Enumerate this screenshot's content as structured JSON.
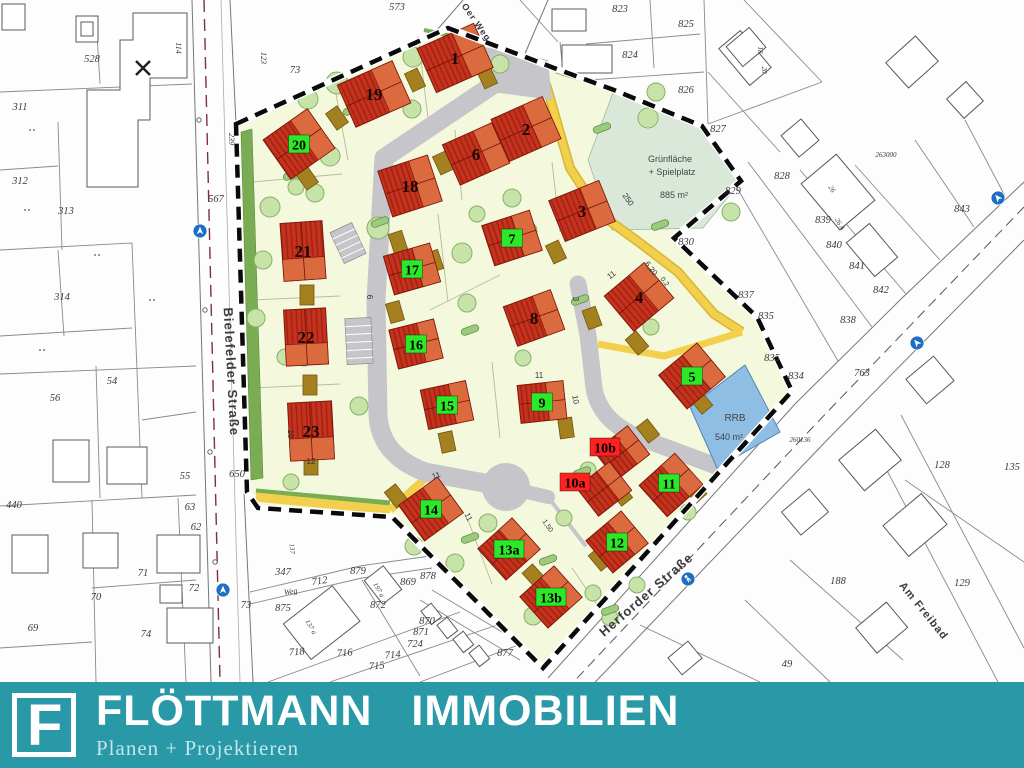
{
  "logo": {
    "brand": "FLÖTTMANN IMMOBILIEN",
    "tagline": "Planen + Projektieren",
    "mark_letter": "F",
    "bar_color": "#2998A7"
  },
  "map": {
    "street_labels": [
      {
        "text": "Bielefelder Straße",
        "x": 227,
        "y": 372,
        "rot": 87,
        "size": 13
      },
      {
        "text": "Herforder Straße",
        "x": 649,
        "y": 598,
        "rot": -41,
        "size": 13
      },
      {
        "text": "Am Freibad",
        "x": 921,
        "y": 613,
        "rot": 51,
        "size": 11
      },
      {
        "text": "Oer Weg",
        "x": 474,
        "y": 24,
        "rot": 55,
        "size": 9
      }
    ],
    "area_labels": [
      {
        "text": "Grünfläche",
        "x": 670,
        "y": 162,
        "size": 9
      },
      {
        "text": "+ Spielplatz",
        "x": 672,
        "y": 175,
        "size": 9
      },
      {
        "text": "885 m²",
        "x": 674,
        "y": 198,
        "size": 9
      },
      {
        "text": "RRB",
        "x": 735,
        "y": 421,
        "size": 10
      },
      {
        "text": "540 m²",
        "x": 729,
        "y": 440,
        "size": 9
      }
    ],
    "lots": [
      {
        "id": "1",
        "badge": "none",
        "x": 455,
        "y": 58,
        "hw": 62,
        "hh": 48,
        "rot": -24
      },
      {
        "id": "19",
        "badge": "none",
        "x": 374,
        "y": 94,
        "hw": 60,
        "hh": 46,
        "rot": -24
      },
      {
        "id": "20",
        "badge": "green",
        "x": 299,
        "y": 144,
        "hw": 54,
        "hh": 48,
        "rot": -35
      },
      {
        "id": "2",
        "badge": "none",
        "x": 526,
        "y": 129,
        "hw": 56,
        "hh": 46,
        "rot": -24
      },
      {
        "id": "6",
        "badge": "none",
        "x": 476,
        "y": 154,
        "hw": 54,
        "hh": 44,
        "rot": -24
      },
      {
        "id": "18",
        "badge": "none",
        "x": 410,
        "y": 186,
        "hw": 52,
        "hh": 48,
        "rot": -18
      },
      {
        "id": "3",
        "badge": "none",
        "x": 582,
        "y": 211,
        "hw": 54,
        "hh": 44,
        "rot": -22
      },
      {
        "id": "7",
        "badge": "green",
        "x": 512,
        "y": 238,
        "hw": 50,
        "hh": 42,
        "rot": -18
      },
      {
        "id": "21",
        "badge": "none",
        "x": 303,
        "y": 251,
        "hw": 42,
        "hh": 58,
        "rot": -4
      },
      {
        "id": "17",
        "badge": "green",
        "x": 412,
        "y": 269,
        "hw": 48,
        "hh": 40,
        "rot": -16
      },
      {
        "id": "4",
        "badge": "none",
        "x": 639,
        "y": 297,
        "hw": 52,
        "hh": 46,
        "rot": -40
      },
      {
        "id": "8",
        "badge": "none",
        "x": 534,
        "y": 318,
        "hw": 50,
        "hh": 42,
        "rot": -20
      },
      {
        "id": "22",
        "badge": "none",
        "x": 306,
        "y": 337,
        "hw": 42,
        "hh": 56,
        "rot": -3
      },
      {
        "id": "16",
        "badge": "green",
        "x": 416,
        "y": 344,
        "hw": 46,
        "hh": 40,
        "rot": -14
      },
      {
        "id": "5",
        "badge": "green",
        "x": 692,
        "y": 376,
        "hw": 50,
        "hh": 44,
        "rot": -40
      },
      {
        "id": "15",
        "badge": "green",
        "x": 447,
        "y": 405,
        "hw": 46,
        "hh": 40,
        "rot": -12
      },
      {
        "id": "9",
        "badge": "green",
        "x": 542,
        "y": 402,
        "hw": 46,
        "hh": 38,
        "rot": -6
      },
      {
        "id": "23",
        "badge": "none",
        "x": 311,
        "y": 431,
        "hw": 44,
        "hh": 58,
        "rot": -3
      },
      {
        "id": "10b",
        "badge": "red",
        "x": 622,
        "y": 453,
        "hw": 42,
        "hh": 36,
        "rot": -38,
        "dx": -17,
        "dy": -6
      },
      {
        "id": "10a",
        "badge": "red",
        "x": 604,
        "y": 489,
        "hw": 42,
        "hh": 36,
        "rot": -38,
        "dx": -29,
        "dy": -7
      },
      {
        "id": "11",
        "badge": "green",
        "x": 671,
        "y": 485,
        "hw": 48,
        "hh": 42,
        "rot": -42,
        "dx": -2,
        "dy": -2
      },
      {
        "id": "14",
        "badge": "green",
        "x": 431,
        "y": 509,
        "hw": 48,
        "hh": 44,
        "rot": -36
      },
      {
        "id": "12",
        "badge": "green",
        "x": 617,
        "y": 542,
        "hw": 46,
        "hh": 42,
        "rot": -40
      },
      {
        "id": "13a",
        "badge": "green",
        "x": 509,
        "y": 549,
        "hw": 46,
        "hh": 42,
        "rot": -42
      },
      {
        "id": "13b",
        "badge": "green",
        "x": 551,
        "y": 597,
        "hw": 46,
        "hh": 42,
        "rot": -42
      }
    ],
    "parcel_labels": [
      {
        "t": "528",
        "x": 92,
        "y": 62
      },
      {
        "t": "311",
        "x": 20,
        "y": 110
      },
      {
        "t": "312",
        "x": 20,
        "y": 184
      },
      {
        "t": "313",
        "x": 66,
        "y": 214
      },
      {
        "t": "314",
        "x": 62,
        "y": 300
      },
      {
        "t": "567",
        "x": 216,
        "y": 202
      },
      {
        "t": "239",
        "x": 229,
        "y": 139,
        "r": 90,
        "s": 8
      },
      {
        "t": "114",
        "x": 176,
        "y": 48,
        "r": 90,
        "s": 8
      },
      {
        "t": "123",
        "x": 261,
        "y": 58,
        "r": 90,
        "s": 8
      },
      {
        "t": "73",
        "x": 295,
        "y": 73
      },
      {
        "t": "573",
        "x": 397,
        "y": 10
      },
      {
        "t": "56",
        "x": 55,
        "y": 401
      },
      {
        "t": "54",
        "x": 112,
        "y": 384
      },
      {
        "t": "55",
        "x": 185,
        "y": 479
      },
      {
        "t": "440",
        "x": 14,
        "y": 508
      },
      {
        "t": "63",
        "x": 190,
        "y": 510
      },
      {
        "t": "62",
        "x": 196,
        "y": 530
      },
      {
        "t": "650",
        "x": 237,
        "y": 477
      },
      {
        "t": "70",
        "x": 96,
        "y": 600
      },
      {
        "t": "71",
        "x": 143,
        "y": 576
      },
      {
        "t": "72",
        "x": 194,
        "y": 591
      },
      {
        "t": "73",
        "x": 246,
        "y": 608
      },
      {
        "t": "74",
        "x": 146,
        "y": 637
      },
      {
        "t": "69",
        "x": 33,
        "y": 631
      },
      {
        "t": "347",
        "x": 283,
        "y": 575
      },
      {
        "t": "712",
        "x": 320,
        "y": 584,
        "r": -8
      },
      {
        "t": "Weg",
        "x": 291,
        "y": 594,
        "r": -8,
        "s": 8
      },
      {
        "t": "875",
        "x": 283,
        "y": 611
      },
      {
        "t": "879",
        "x": 358,
        "y": 574
      },
      {
        "t": "872",
        "x": 378,
        "y": 608
      },
      {
        "t": "869",
        "x": 408,
        "y": 585
      },
      {
        "t": "878",
        "x": 428,
        "y": 579
      },
      {
        "t": "870",
        "x": 427,
        "y": 624
      },
      {
        "t": "871",
        "x": 421,
        "y": 635
      },
      {
        "t": "724",
        "x": 415,
        "y": 647
      },
      {
        "t": "718",
        "x": 297,
        "y": 655,
        "r": -5
      },
      {
        "t": "716",
        "x": 345,
        "y": 656,
        "r": -5
      },
      {
        "t": "714",
        "x": 393,
        "y": 658,
        "r": -5
      },
      {
        "t": "715",
        "x": 377,
        "y": 669,
        "r": -5
      },
      {
        "t": "877",
        "x": 505,
        "y": 656
      },
      {
        "t": "137",
        "x": 290,
        "y": 549,
        "r": 85,
        "s": 7
      },
      {
        "t": "137 a",
        "x": 309,
        "y": 628,
        "r": 60,
        "s": 7
      },
      {
        "t": "197 a",
        "x": 377,
        "y": 591,
        "r": 60,
        "s": 7
      },
      {
        "t": "823",
        "x": 620,
        "y": 12
      },
      {
        "t": "825",
        "x": 686,
        "y": 27
      },
      {
        "t": "824",
        "x": 630,
        "y": 58
      },
      {
        "t": "826",
        "x": 686,
        "y": 93
      },
      {
        "t": "827",
        "x": 718,
        "y": 132
      },
      {
        "t": "828",
        "x": 782,
        "y": 179
      },
      {
        "t": "829",
        "x": 733,
        "y": 194
      },
      {
        "t": "830",
        "x": 686,
        "y": 245
      },
      {
        "t": "837",
        "x": 746,
        "y": 298
      },
      {
        "t": "839",
        "x": 823,
        "y": 223
      },
      {
        "t": "840",
        "x": 834,
        "y": 248
      },
      {
        "t": "841",
        "x": 857,
        "y": 269
      },
      {
        "t": "842",
        "x": 881,
        "y": 293
      },
      {
        "t": "838",
        "x": 848,
        "y": 323
      },
      {
        "t": "843",
        "x": 962,
        "y": 212
      },
      {
        "t": "835",
        "x": 766,
        "y": 319
      },
      {
        "t": "835",
        "x": 772,
        "y": 361
      },
      {
        "t": "834",
        "x": 796,
        "y": 379
      },
      {
        "t": "763",
        "x": 862,
        "y": 376
      },
      {
        "t": "263000",
        "x": 886,
        "y": 157,
        "s": 7
      },
      {
        "t": "260136",
        "x": 800,
        "y": 442,
        "s": 7
      },
      {
        "t": "128",
        "x": 942,
        "y": 468
      },
      {
        "t": "135",
        "x": 1012,
        "y": 470
      },
      {
        "t": "129",
        "x": 962,
        "y": 586
      },
      {
        "t": "188",
        "x": 838,
        "y": 584
      },
      {
        "t": "49",
        "x": 787,
        "y": 667
      },
      {
        "t": "18",
        "x": 758,
        "y": 50,
        "r": 90,
        "s": 7
      },
      {
        "t": "20",
        "x": 762,
        "y": 70,
        "r": 90,
        "s": 7
      },
      {
        "t": "26",
        "x": 830,
        "y": 190,
        "r": 60,
        "s": 7
      },
      {
        "t": "26 A",
        "x": 838,
        "y": 225,
        "r": 60,
        "s": 7
      }
    ],
    "dim_labels": [
      {
        "t": "250",
        "x": 626,
        "y": 201,
        "r": 55,
        "s": 8
      },
      {
        "t": "11",
        "x": 613,
        "y": 277,
        "r": -38,
        "s": 8
      },
      {
        "t": "6,20",
        "x": 649,
        "y": 270,
        "r": 52,
        "s": 8
      },
      {
        "t": "0,2",
        "x": 663,
        "y": 283,
        "r": 52,
        "s": 7
      },
      {
        "t": "11",
        "x": 539,
        "y": 378,
        "r": 0,
        "s": 8
      },
      {
        "t": "10",
        "x": 573,
        "y": 400,
        "r": 80,
        "s": 8
      },
      {
        "t": "16",
        "x": 288,
        "y": 434,
        "r": 90,
        "s": 8
      },
      {
        "t": "12",
        "x": 311,
        "y": 464,
        "r": 0,
        "s": 8
      },
      {
        "t": "11",
        "x": 437,
        "y": 478,
        "r": -20,
        "s": 8
      },
      {
        "t": "11",
        "x": 466,
        "y": 518,
        "r": 65,
        "s": 8
      },
      {
        "t": "1,50",
        "x": 546,
        "y": 527,
        "r": 55,
        "s": 7
      },
      {
        "t": "3",
        "x": 573,
        "y": 299,
        "r": 90,
        "s": 8
      },
      {
        "t": "6",
        "x": 367,
        "y": 297,
        "r": 90,
        "s": 8
      }
    ],
    "markers": [
      {
        "x": 200,
        "y": 231,
        "rot": 0
      },
      {
        "x": 223,
        "y": 590,
        "rot": 0
      },
      {
        "x": 688,
        "y": 579,
        "rot": -40,
        "type": "ped"
      },
      {
        "x": 917,
        "y": 343,
        "rot": -40
      },
      {
        "x": 998,
        "y": 198,
        "rot": -40
      }
    ],
    "legend_colors": {
      "roof": "#C5321E",
      "roof_dark": "#9E2110",
      "roof_light": "#DB6B3F",
      "badge_green": "#2BE828",
      "badge_red": "#FF2020",
      "site": "#F4F8DC",
      "green_area": "#D9E8D9",
      "pond": "#8FBEE4",
      "path_yellow": "#F2CF4C",
      "road_gray": "#C6C6CA",
      "hedge": "#79AC53"
    }
  }
}
